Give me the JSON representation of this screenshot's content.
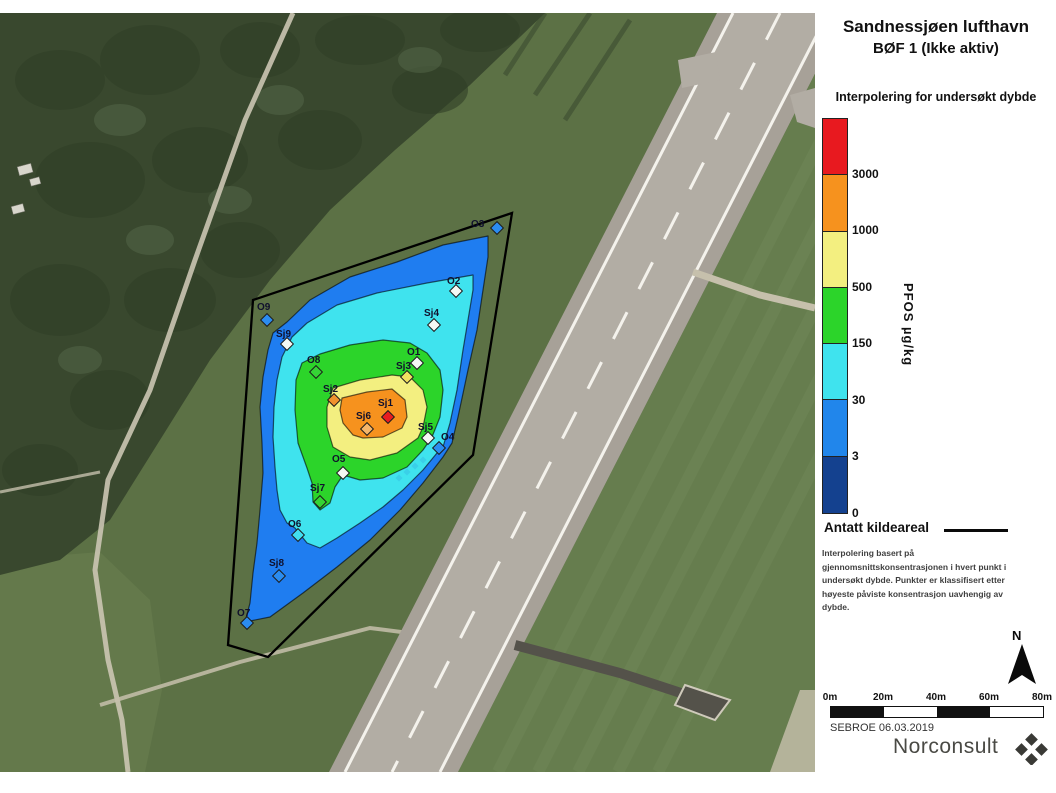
{
  "panel": {
    "title_line1": "Sandnessjøen lufthavn",
    "title_line2": "BØF 1 (Ikke aktiv)",
    "legend_title": "Interpolering for undersøkt dybde",
    "unit_label": "PFOS µg/kg",
    "scale": {
      "colors": [
        "#e8191f",
        "#f6921e",
        "#f3ef80",
        "#2cd42a",
        "#3fe3ee",
        "#2186eb",
        "#14418f"
      ],
      "tick_labels": [
        "3000",
        "1000",
        "500",
        "150",
        "30",
        "3",
        "0"
      ]
    },
    "kildeareal_label": "Antatt kildeareal",
    "note": "Interpolering basert på gjennomsnittskonsentrasjonen i hvert punkt i undersøkt dybde. Punkter er klassifisert etter høyeste påviste konsentrasjon uavhengig av dybde.",
    "north_label": "N",
    "scalebar_labels": [
      "0m",
      "20m",
      "40m",
      "60m",
      "80m"
    ],
    "credit": "SEBROE 06.03.2019",
    "logo_text": "Norconsult"
  },
  "map": {
    "source_area": {
      "label": "Antatt kildeareal",
      "points": [
        [
          512,
          213
        ],
        [
          473,
          455
        ],
        [
          268,
          657
        ],
        [
          228,
          645
        ],
        [
          253,
          300
        ]
      ]
    },
    "contours": [
      {
        "range": "3-30",
        "unit": "µg/kg",
        "color": "#1f7df0",
        "points": [
          [
            488,
            236
          ],
          [
            443,
            245
          ],
          [
            397,
            262
          ],
          [
            350,
            277
          ],
          [
            310,
            300
          ],
          [
            287,
            322
          ],
          [
            273,
            333
          ],
          [
            268,
            350
          ],
          [
            263,
            377
          ],
          [
            260,
            407
          ],
          [
            262,
            443
          ],
          [
            263,
            473
          ],
          [
            260,
            510
          ],
          [
            257,
            543
          ],
          [
            253,
            573
          ],
          [
            250,
            603
          ],
          [
            245,
            622
          ],
          [
            270,
            617
          ],
          [
            303,
            593
          ],
          [
            337,
            567
          ],
          [
            370,
            540
          ],
          [
            400,
            510
          ],
          [
            423,
            483
          ],
          [
            443,
            457
          ],
          [
            452,
            443
          ],
          [
            458,
            417
          ],
          [
            468,
            370
          ],
          [
            477,
            330
          ],
          [
            483,
            290
          ],
          [
            488,
            257
          ]
        ]
      },
      {
        "range": "30-150",
        "unit": "µg/kg",
        "color": "#3fe3ee",
        "points": [
          [
            473,
            275
          ],
          [
            427,
            283
          ],
          [
            377,
            293
          ],
          [
            337,
            305
          ],
          [
            307,
            323
          ],
          [
            292,
            337
          ],
          [
            282,
            357
          ],
          [
            277,
            380
          ],
          [
            274,
            407
          ],
          [
            273,
            437
          ],
          [
            275,
            467
          ],
          [
            277,
            490
          ],
          [
            280,
            510
          ],
          [
            287,
            523
          ],
          [
            295,
            528
          ],
          [
            307,
            543
          ],
          [
            320,
            548
          ],
          [
            337,
            538
          ],
          [
            360,
            523
          ],
          [
            383,
            507
          ],
          [
            403,
            490
          ],
          [
            423,
            470
          ],
          [
            437,
            453
          ],
          [
            443,
            447
          ],
          [
            450,
            423
          ],
          [
            457,
            390
          ],
          [
            463,
            350
          ],
          [
            468,
            320
          ],
          [
            473,
            290
          ]
        ]
      },
      {
        "range": "150-500",
        "unit": "µg/kg",
        "color": "#2cd42a",
        "points": [
          [
            320,
            354
          ],
          [
            350,
            345
          ],
          [
            383,
            340
          ],
          [
            410,
            343
          ],
          [
            427,
            353
          ],
          [
            440,
            370
          ],
          [
            443,
            390
          ],
          [
            440,
            417
          ],
          [
            432,
            437
          ],
          [
            423,
            450
          ],
          [
            407,
            467
          ],
          [
            383,
            478
          ],
          [
            360,
            480
          ],
          [
            343,
            475
          ],
          [
            335,
            487
          ],
          [
            330,
            503
          ],
          [
            320,
            510
          ],
          [
            313,
            502
          ],
          [
            312,
            483
          ],
          [
            307,
            468
          ],
          [
            298,
            443
          ],
          [
            295,
            410
          ],
          [
            296,
            380
          ],
          [
            302,
            363
          ]
        ]
      },
      {
        "range": "500-1000",
        "unit": "µg/kg",
        "color": "#f3ef80",
        "points": [
          [
            333,
            388
          ],
          [
            360,
            380
          ],
          [
            392,
            375
          ],
          [
            410,
            377
          ],
          [
            423,
            390
          ],
          [
            427,
            407
          ],
          [
            423,
            427
          ],
          [
            418,
            438
          ],
          [
            397,
            453
          ],
          [
            370,
            460
          ],
          [
            350,
            457
          ],
          [
            333,
            447
          ],
          [
            327,
            427
          ],
          [
            327,
            407
          ]
        ]
      },
      {
        "range": "1000-3000",
        "unit": "µg/kg",
        "color": "#f6921e",
        "points": [
          [
            342,
            398
          ],
          [
            367,
            392
          ],
          [
            392,
            389
          ],
          [
            405,
            400
          ],
          [
            407,
            417
          ],
          [
            402,
            428
          ],
          [
            383,
            437
          ],
          [
            363,
            438
          ],
          [
            353,
            435
          ],
          [
            343,
            423
          ],
          [
            340,
            410
          ]
        ]
      }
    ],
    "dashes": [
      [
        399,
        478
      ],
      [
        407,
        472
      ],
      [
        415,
        466
      ],
      [
        423,
        460
      ]
    ],
    "points": [
      {
        "id": "O3",
        "x": 497,
        "y": 228,
        "color": "#2b8cf0",
        "lx": 471,
        "ly": 227
      },
      {
        "id": "O2",
        "x": 456,
        "y": 291,
        "color": "#f4f8f4",
        "lx": 447,
        "ly": 284
      },
      {
        "id": "Sj4",
        "x": 434,
        "y": 325,
        "color": "#f4f8f4",
        "lx": 424,
        "ly": 316
      },
      {
        "id": "O9",
        "x": 267,
        "y": 320,
        "color": "#2b8cf0",
        "lx": 257,
        "ly": 310
      },
      {
        "id": "Sj9",
        "x": 287,
        "y": 344,
        "color": "#f4f8f4",
        "lx": 276,
        "ly": 337
      },
      {
        "id": "O8",
        "x": 316,
        "y": 372,
        "color": "#35d435",
        "lx": 307,
        "ly": 363
      },
      {
        "id": "O1",
        "x": 417,
        "y": 363,
        "color": "#f4f8f4",
        "lx": 407,
        "ly": 355
      },
      {
        "id": "Sj3",
        "x": 407,
        "y": 377,
        "color": "#f0e060",
        "lx": 396,
        "ly": 369
      },
      {
        "id": "Sj2",
        "x": 334,
        "y": 400,
        "color": "#f0922e",
        "lx": 323,
        "ly": 392
      },
      {
        "id": "Sj1",
        "x": 388,
        "y": 417,
        "color": "#e81c20",
        "lx": 378,
        "ly": 406
      },
      {
        "id": "Sj6",
        "x": 367,
        "y": 429,
        "color": "#f5b66a",
        "lx": 356,
        "ly": 419
      },
      {
        "id": "Sj5",
        "x": 428,
        "y": 438,
        "color": "#f4f8f4",
        "lx": 418,
        "ly": 430
      },
      {
        "id": "O4",
        "x": 439,
        "y": 448,
        "color": "#2b8cf0",
        "lx": 441,
        "ly": 440
      },
      {
        "id": "O5",
        "x": 343,
        "y": 473,
        "color": "#f4f8f4",
        "lx": 332,
        "ly": 462
      },
      {
        "id": "Sj7",
        "x": 320,
        "y": 502,
        "color": "#35d435",
        "lx": 310,
        "ly": 491
      },
      {
        "id": "O6",
        "x": 298,
        "y": 535,
        "color": "#41dff0",
        "lx": 288,
        "ly": 527
      },
      {
        "id": "Sj8",
        "x": 279,
        "y": 576,
        "color": "#2b8cf0",
        "lx": 269,
        "ly": 566
      },
      {
        "id": "O7",
        "x": 247,
        "y": 623,
        "color": "#2b8cf0",
        "lx": 237,
        "ly": 616
      }
    ]
  }
}
